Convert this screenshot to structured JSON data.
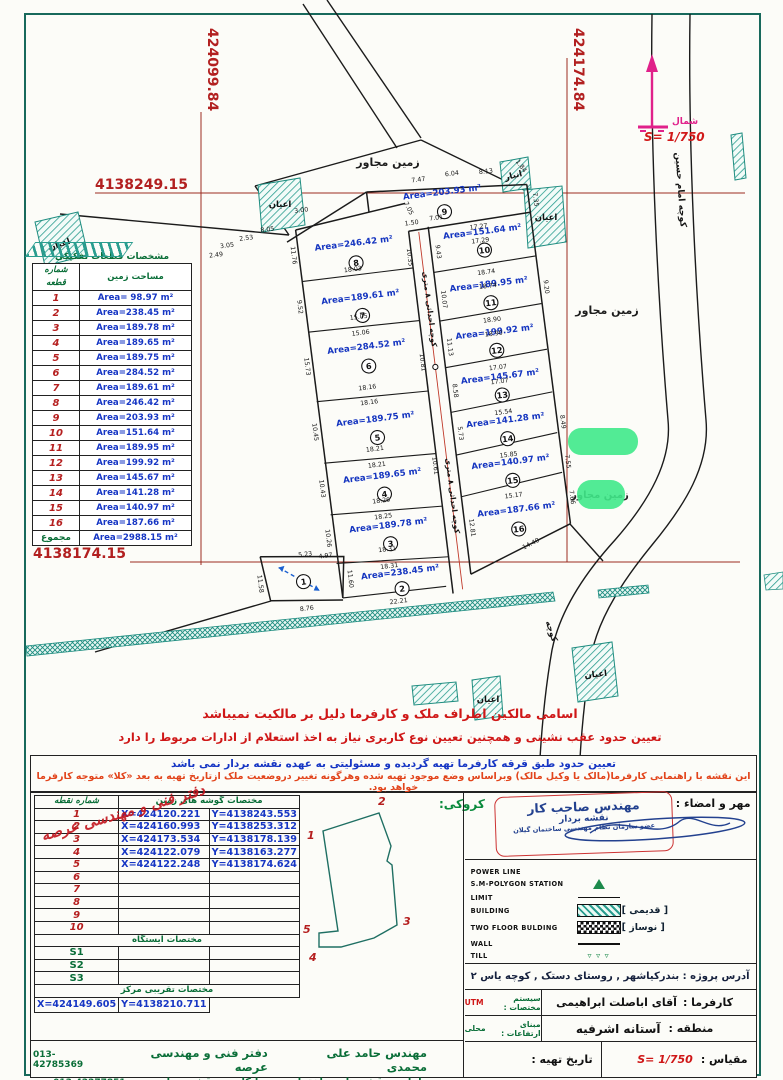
{
  "grid": {
    "x1": "424099.84",
    "x2": "424174.84",
    "y1": "4138249.15",
    "y2": "4138174.15"
  },
  "north": {
    "word": "شمال",
    "scale": "S= 1/750"
  },
  "map_labels": {
    "adjacent_land": "زمین مجاور",
    "imam_alley": "کوچه امام حسین",
    "new_alley": "کوچه احداثی ۸ متری",
    "alley": "کوچه",
    "ayan": "اعیان",
    "anbar": "انبار"
  },
  "plots_table": {
    "title": "مشخصات قطعات تفکیکی",
    "col_no": "شماره قطعه",
    "col_area": "مساحت زمین",
    "total_label": "مجموع",
    "total_area": "Area=2988.15 m²"
  },
  "plots": [
    {
      "no": "1",
      "area": "Area= 98.97 m²"
    },
    {
      "no": "2",
      "area": "Area=238.45 m²"
    },
    {
      "no": "3",
      "area": "Area=189.78 m²"
    },
    {
      "no": "4",
      "area": "Area=189.65 m²"
    },
    {
      "no": "5",
      "area": "Area=189.75 m²"
    },
    {
      "no": "6",
      "area": "Area=284.52 m²"
    },
    {
      "no": "7",
      "area": "Area=189.61 m²"
    },
    {
      "no": "8",
      "area": "Area=246.42 m²"
    },
    {
      "no": "9",
      "area": "Area=203.93 m²"
    },
    {
      "no": "10",
      "area": "Area=151.64 m²"
    },
    {
      "no": "11",
      "area": "Area=189.95 m²"
    },
    {
      "no": "12",
      "area": "Area=199.92 m²"
    },
    {
      "no": "13",
      "area": "Area=145.67 m²"
    },
    {
      "no": "14",
      "area": "Area=141.28 m²"
    },
    {
      "no": "15",
      "area": "Area=140.97 m²"
    },
    {
      "no": "16",
      "area": "Area=187.66 m²"
    }
  ],
  "dims": [
    "3.05",
    "2.49",
    "2.53",
    "8.05",
    "3.00",
    "7.47",
    "6.04",
    "8.13",
    "1.84",
    "7.05",
    "1.50",
    "7.01",
    "18.03",
    "15.05",
    "15.06",
    "18.16",
    "18.16",
    "18.21",
    "18.21",
    "18.26",
    "18.25",
    "18.31",
    "18.31",
    "22.21",
    "11.76",
    "9.52",
    "15.73",
    "10.45",
    "10.43",
    "10.26",
    "17.27",
    "17.29",
    "18.74",
    "18.74",
    "18.90",
    "18.90",
    "17.07",
    "17.07",
    "15.54",
    "15.85",
    "15.17",
    "14.40",
    "9.43",
    "10.07",
    "11.13",
    "8.58",
    "5.73",
    "12.81",
    "7.35",
    "9.20",
    "8.49",
    "7.55",
    "7.66",
    "10.35",
    "10.81",
    "10.61",
    "11.58",
    "11.60",
    "5.23",
    "4.97",
    "8.76"
  ],
  "warnings": [
    "اسامی مالکین اطراف ملک و کارفرما دلیل بر مالکیت نمیباشد",
    "تعیین حدود عقب نشینی و همچنین تعیین نوع کاربری نیاز به اخذ استعلام از ادارات مربوط را دارد"
  ],
  "notes": [
    "تعیین حدود طبق قرقه کارفرما تهیه گردیده و مسئولیتی به عهده نقشه بردار نمی باشد",
    "این نقشه با راهنمایی کارفرما(مالک یا وکیل مالک) وبراساس وضع موجود تهیه شده وهرگونه تغییر دروضعیت ملک ازتاریخ تهیه به بعد «کلا» متوجه کارفرما خواهد بود."
  ],
  "coords_table": {
    "title": "مختصات گوشه های زمین",
    "col_no": "شماره نقطه",
    "points": [
      {
        "no": "1",
        "x": "X=424120.221",
        "y": "Y=4138243.553"
      },
      {
        "no": "2",
        "x": "X=424160.993",
        "y": "Y=4138253.312"
      },
      {
        "no": "3",
        "x": "X=424173.534",
        "y": "Y=4138178.139"
      },
      {
        "no": "4",
        "x": "X=424122.079",
        "y": "Y=4138163.277"
      },
      {
        "no": "5",
        "x": "X=424122.248",
        "y": "Y=4138174.624"
      },
      {
        "no": "6",
        "x": "",
        "y": ""
      },
      {
        "no": "7",
        "x": "",
        "y": ""
      },
      {
        "no": "8",
        "x": "",
        "y": ""
      },
      {
        "no": "9",
        "x": "",
        "y": ""
      },
      {
        "no": "10",
        "x": "",
        "y": ""
      }
    ],
    "station_title": "مختصات ایستگاه",
    "stations": [
      "S1",
      "S2",
      "S3"
    ],
    "center_title": "مختصات تقریبی مرکز",
    "center": {
      "x": "X=424149.605",
      "y": "Y=4138210.711"
    }
  },
  "sketch": {
    "label": "کروکی:",
    "points": [
      "1",
      "2",
      "3",
      "4",
      "5"
    ]
  },
  "seal": {
    "label": "مهر و امضاء :",
    "line1": "مهندس صاحب کار",
    "line2": "نقشه بردار",
    "line3": "عضو سازمان نظام مهندسی ساختمان گیلان"
  },
  "legend": {
    "items": [
      {
        "en": "POWER LINE",
        "sym": "none",
        "fa": ""
      },
      {
        "en": "S.M-POLYGON STATION",
        "sym": "triangle",
        "fa": ""
      },
      {
        "en": "LIMIT",
        "sym": "line",
        "fa": ""
      },
      {
        "en": "BUILDING",
        "sym": "hatch",
        "fa": "[ قدیمی ]"
      },
      {
        "en": "TWO FLOOR BULDING",
        "sym": "checker",
        "fa": "[ نوساز ]"
      },
      {
        "en": "WALL",
        "sym": "wall",
        "fa": ""
      },
      {
        "en": "TILL",
        "sym": "till",
        "fa": ""
      }
    ]
  },
  "info": {
    "address": "آدرس پروژه : بندرکیاشهر , روستای دستک , کوچه یاس ۲",
    "client_label": "کارفرما :",
    "client": "آقای اباصلت ابراهیمی",
    "coord_sys_label": "سیستم مختصات :",
    "coord_sys": "UTM",
    "region_label": "منطقه :",
    "region": "آستانه اشرفیه",
    "elev_label": "مبنای ارتفاعات :",
    "elev": "محلی",
    "scale_label": "مقیاس :",
    "scale": "S= 1/750",
    "date_label": "تاریخ تهیه :"
  },
  "office": {
    "name": "دفتر فنی و مهندسی عرصه",
    "engineer": "مهندس حامد علی محمدی",
    "services": "طراحی نقشه های ساختمانی , پیمانکاری , نقشه برداری",
    "phone1": "013-42785369",
    "phone2": "013-42277851",
    "mobile": "09113777450",
    "address": "آدرس : بندر کیاشهر , دستک , روبروی بانک صادرات",
    "calligraphy": "دفتر فنی و مهندسی عرصه"
  }
}
